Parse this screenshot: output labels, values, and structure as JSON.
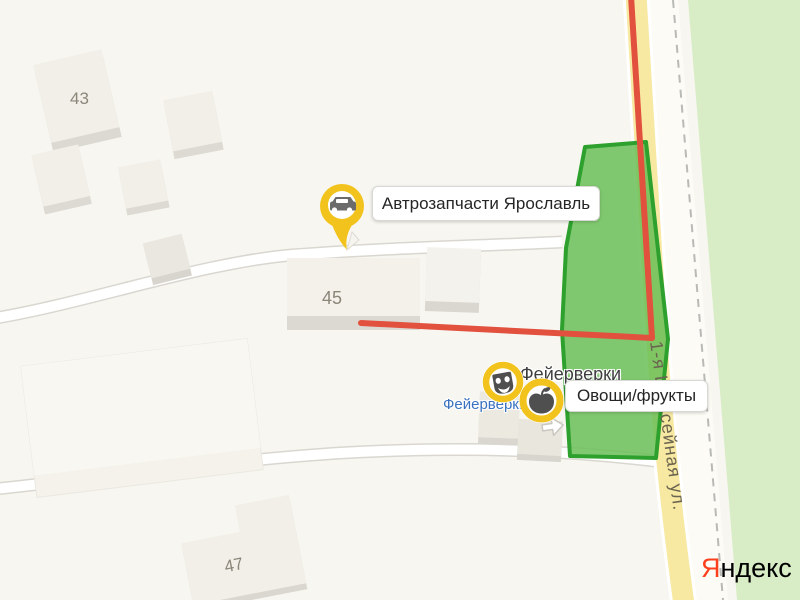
{
  "map": {
    "street": {
      "name": "1-я Шоссейная ул."
    },
    "buildings": {
      "b43": {
        "number": "43"
      },
      "b45": {
        "number": "45"
      },
      "b47": {
        "number": "47"
      }
    },
    "colors": {
      "background": "#f7f6f0",
      "forest": "#d8edc6",
      "road_yellow": "#f8e9a2",
      "route_red": "#e2503e",
      "selection_fill": "#6ac058",
      "selection_stroke": "#2da02d",
      "marker_yellow": "#f4c51d",
      "icon_gray": "#4f4f4f"
    }
  },
  "pois": {
    "auto_parts": {
      "label": "Автрозапчасти Ярославль",
      "icon": "car-icon"
    },
    "fireworks_badge": {
      "label": "Фейерверки",
      "icon": "theater-mask-icon"
    },
    "fireworks_place": {
      "label": "Фейерверки"
    },
    "produce": {
      "label": "Овощи/фрукты",
      "icon": "apple-icon"
    }
  },
  "logo": {
    "ya": "Я",
    "rest": "ндекс"
  }
}
